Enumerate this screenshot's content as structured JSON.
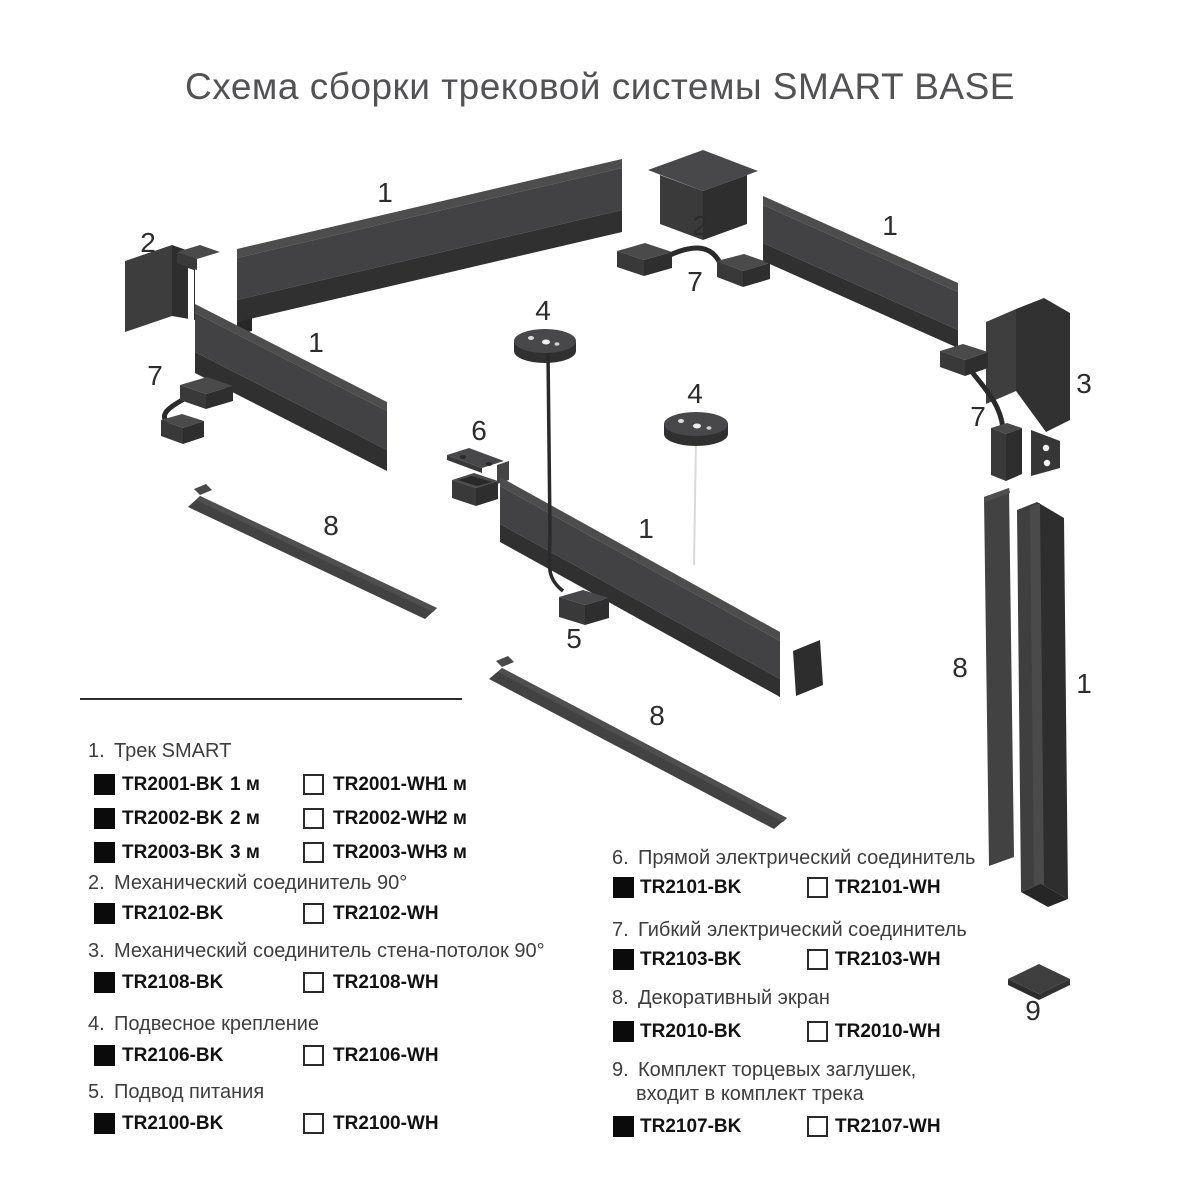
{
  "title": "Схема сборки трековой системы SMART BASE",
  "diagram": {
    "labels": [
      "1",
      "2",
      "1",
      "7",
      "2",
      "7",
      "1",
      "3",
      "7",
      "4",
      "4",
      "6",
      "1",
      "8",
      "5",
      "8",
      "8",
      "1",
      "9"
    ]
  },
  "legend": {
    "items_left": [
      {
        "number": "1.",
        "name": "Трек SMART",
        "rows": [
          {
            "bk_code": "TR2001-BK",
            "bk_size": "1 м",
            "wh_code": "TR2001-WH",
            "wh_size": "1 м"
          },
          {
            "bk_code": "TR2002-BK",
            "bk_size": "2 м",
            "wh_code": "TR2002-WH",
            "wh_size": "2 м"
          },
          {
            "bk_code": "TR2003-BK",
            "bk_size": "3 м",
            "wh_code": "TR2003-WH",
            "wh_size": "3 м"
          }
        ]
      },
      {
        "number": "2.",
        "name": "Механический соединитель 90°",
        "rows": [
          {
            "bk_code": "TR2102-BK",
            "wh_code": "TR2102-WH"
          }
        ]
      },
      {
        "number": "3.",
        "name": "Механический соединитель стена-потолок 90°",
        "rows": [
          {
            "bk_code": "TR2108-BK",
            "wh_code": "TR2108-WH"
          }
        ]
      },
      {
        "number": "4.",
        "name": "Подвесное крепление",
        "rows": [
          {
            "bk_code": "TR2106-BK",
            "wh_code": "TR2106-WH"
          }
        ]
      },
      {
        "number": "5.",
        "name": "Подвод питания",
        "rows": [
          {
            "bk_code": "TR2100-BK",
            "wh_code": "TR2100-WH"
          }
        ]
      }
    ],
    "items_right": [
      {
        "number": "6.",
        "name": "Прямой электрический соединитель",
        "rows": [
          {
            "bk_code": "TR2101-BK",
            "wh_code": "TR2101-WH"
          }
        ]
      },
      {
        "number": "7.",
        "name": "Гибкий электрический соединитель",
        "rows": [
          {
            "bk_code": "TR2103-BK",
            "wh_code": "TR2103-WH"
          }
        ]
      },
      {
        "number": "8.",
        "name": "Декоративный экран",
        "rows": [
          {
            "bk_code": "TR2010-BK",
            "wh_code": "TR2010-WH"
          }
        ]
      },
      {
        "number": "9.",
        "name": "Комплект торцевых заглушек,",
        "name_line2": "входит в комплект трека",
        "rows": [
          {
            "bk_code": "TR2107-BK",
            "wh_code": "TR2107-WH"
          }
        ]
      }
    ]
  },
  "colors": {
    "component_gray": "#3e3e3f",
    "component_light": "#4a4a4b",
    "component_dark": "#2e2e2f",
    "code_text": "#121212",
    "label_text": "#3e3e3e",
    "title_text": "#525254",
    "bk_swatch": "#0b0b0b",
    "wh_swatch_border": "#2a2a2a"
  }
}
